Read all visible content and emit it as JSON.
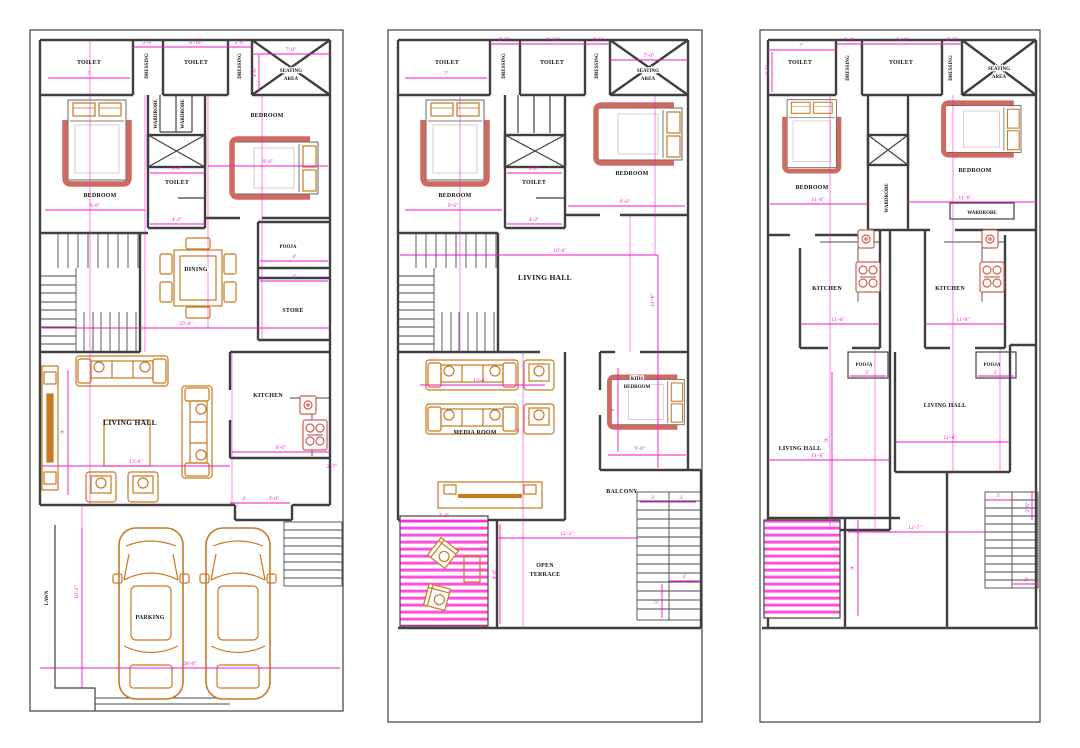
{
  "colors": {
    "wall": "#3f3f3f",
    "dimension": "#f313cf",
    "furniture": "#c9791f",
    "fixture": "#cf6a60",
    "hatch": "#ff4fdc",
    "background": "#ffffff"
  },
  "plans": {
    "left": {
      "rooms": {
        "toilet_left": "TOILET",
        "dressing_left": "DRESSING",
        "toilet_mid": "TOILET",
        "dressing_right": "DRESSING",
        "seating_line1": "SEATING",
        "seating_line2": "AREA",
        "wardrobe_left": "WARDROBE",
        "wardrobe_right": "WARDROBE",
        "bedroom_left": "BEDROOM",
        "bedroom_right": "BEDROOM",
        "toilet_center": "TOILET",
        "pooja": "POOJA",
        "dining": "DINING",
        "store": "STORE",
        "kitchen": "KITCHEN",
        "living_hall": "LIVING HALL",
        "lawn": "LAWN",
        "parking": "PARKING"
      },
      "dims": [
        "7'",
        "2'-6\"",
        "6'-10\"",
        "2'-6\"",
        "7'-0\"",
        "3'-6\"",
        "9'-6\"",
        "3'-2\"",
        "9'-6\"",
        "4'-2\"",
        "4'",
        "4'",
        "23'-0\"",
        "9'",
        "13'-6\"",
        "9'-6\"",
        "2'-7\"",
        "4'",
        "2'-0\"",
        "16'-2\"",
        "28'-0\""
      ]
    },
    "middle": {
      "rooms": {
        "toilet_left": "TOILET",
        "dressing_left": "DRESSING",
        "toilet_mid": "TOILET",
        "dressing_right": "DRESSING",
        "seating_line1": "SEATING",
        "seating_line2": "AREA",
        "bedroom_left": "BEDROOM",
        "bedroom_right": "BEDROOM",
        "toilet_center": "TOILET",
        "living_hall": "LIVING HALL",
        "media_room": "MEDIA ROOM",
        "kids_line1": "KIDS",
        "kids_line2": "BEDROOM",
        "balcony": "BALCONY",
        "terrace_line1": "OPEN",
        "terrace_line2": "TERRACE"
      },
      "dims": [
        "2'-6\"",
        "6'-10\"",
        "2'-6\"",
        "7'",
        "7'-0\"",
        "9'-6\"",
        "9'-6\"",
        "3'-2\"",
        "4'-2\"",
        "18'-0\"",
        "11'-6\"",
        "13'-6\"",
        "9'",
        "9'",
        "9'-0\"",
        "3'",
        "3'",
        "7'-3\"",
        "12'-3\"",
        "9'-6\"",
        "3'",
        "5'"
      ]
    },
    "right": {
      "rooms": {
        "toilet_left": "TOILET",
        "dressing_left": "DRESSING",
        "toilet_mid": "TOILET",
        "dressing_right": "DRESSING",
        "seating_line1": "SEATING",
        "seating_line2": "AREA",
        "bedroom_left": "BEDROOM",
        "bedroom_right": "BEDROOM",
        "wardrobe_mid": "WARDROBE",
        "wardrobe_box": "WARDROBE",
        "kitchen_left": "KITCHEN",
        "kitchen_right": "KITCHEN",
        "pooja_left": "POOJA",
        "pooja_right": "POOJA",
        "living_left": "LIVING HALL",
        "living_right": "LIVING HALL"
      },
      "dims": [
        "7'",
        "2'-6\"",
        "6'-10\"",
        "2'-6\"",
        "3'-6\"",
        "11'-6\"",
        "11'-6\"",
        "11'-6\"",
        "11'-6\"",
        "3'",
        "3'",
        "11'-6\"",
        "11'-6\"",
        "9'",
        "12'-7\"",
        "9'",
        "3'",
        "3'",
        "2'-6\""
      ]
    }
  }
}
